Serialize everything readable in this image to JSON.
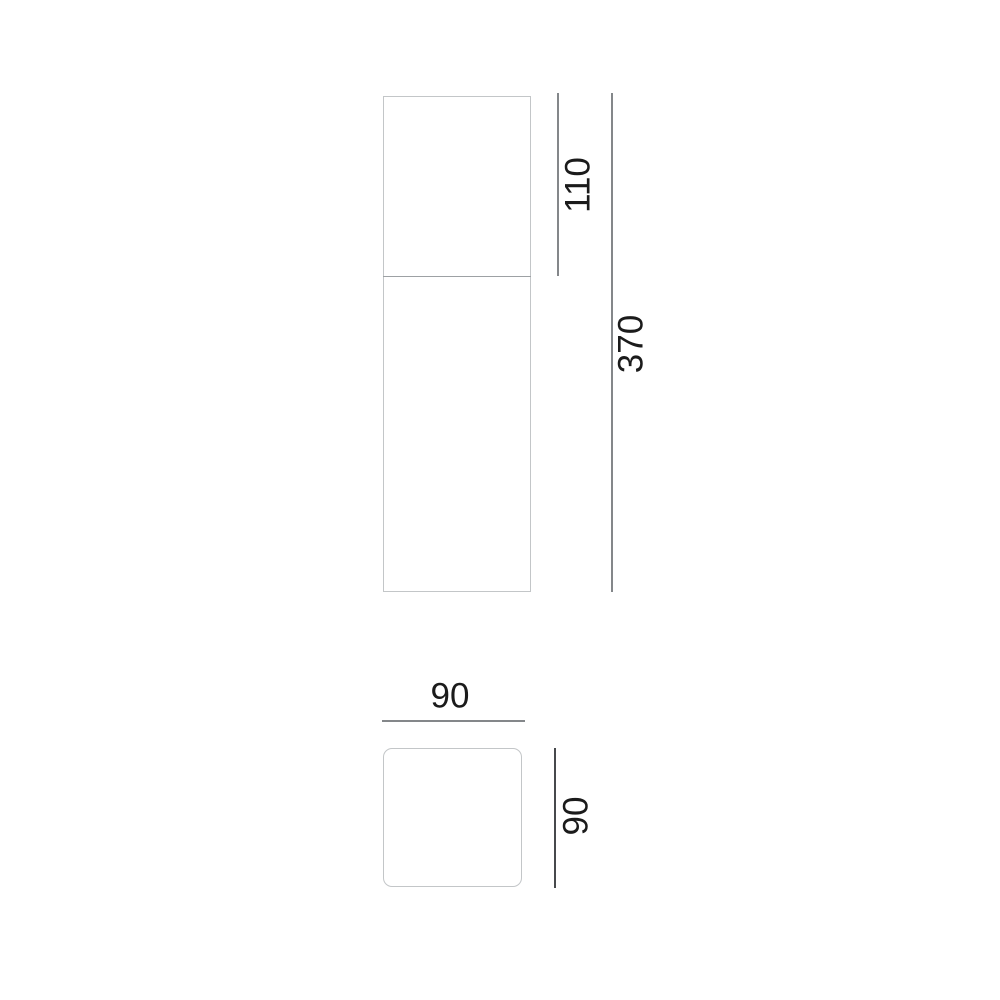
{
  "drawing": {
    "side_view": {
      "top_section_height": "110",
      "total_height": "370"
    },
    "top_view": {
      "width": "90",
      "depth": "90"
    }
  },
  "colors": {
    "background": "#ffffff",
    "outline": "#c3c6c8",
    "divider": "#9da1a4",
    "dim_line": "#84878a",
    "dim_line_dark": "#47494c",
    "text": "#1b1b1b"
  }
}
